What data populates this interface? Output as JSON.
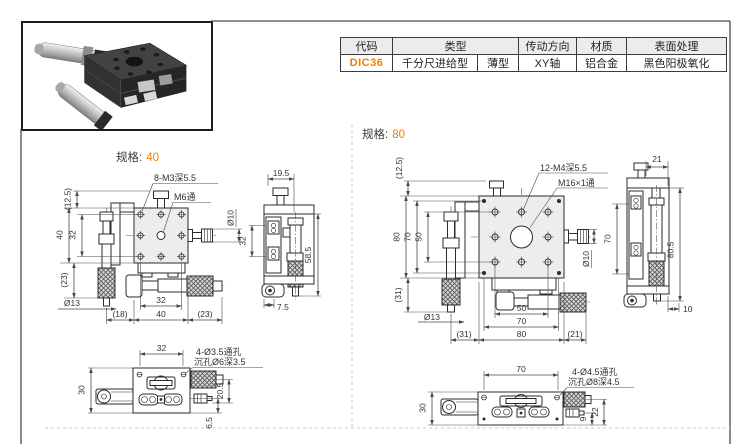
{
  "colors": {
    "accent": "#f07f00",
    "drawing_line": "#2b2b2b",
    "dimension_line": "#4a4a4a",
    "table_header_bg": "#ececec",
    "page_bg": "#ffffff"
  },
  "product_table": {
    "headers": {
      "code": "代码",
      "type": "类型",
      "drive_direction": "传动方向",
      "material": "材质",
      "surface_finish": "表面处理"
    },
    "row": {
      "code": "DIC36",
      "type_main": "千分尺进给型",
      "type_sub": "薄型",
      "drive_direction": "XY轴",
      "material": "铝合金",
      "surface_finish": "黑色阳极氧化"
    }
  },
  "spec40": {
    "spec_label": "规格:",
    "spec_value": "40",
    "top_view": {
      "callout_holes": "8-M3深5.5",
      "callout_center_hole": "M6通",
      "dim_knob_dia": "Ø10",
      "dim_stage_offset": "(12.5)",
      "dim_height": "40",
      "dim_hole_pitch_v": "32",
      "dim_mic_below": "(23)",
      "dim_mic_dia": "Ø13",
      "dim_left_offset": "(18)",
      "dim_hole_pitch_h": "32",
      "dim_width": "40",
      "dim_right_offset": "(23)"
    },
    "side_view": {
      "dim_top": "19.5",
      "dim_left": "32",
      "dim_height": "58.5",
      "dim_bottom": "7.5"
    },
    "bottom_view": {
      "dim_width": "32",
      "callout_holes": "4-Ø3.5通孔",
      "callout_cbore": "沉孔Ø6深3.5",
      "dim_height": "30",
      "dim_right": "20.5",
      "dim_offset": "6.5"
    }
  },
  "spec80": {
    "spec_label": "规格:",
    "spec_value": "80",
    "top_view": {
      "callout_holes": "12-M4深5.5",
      "callout_center_hole": "M16×1通",
      "dim_knob_dia": "Ø10",
      "dim_stage_offset": "(12.5)",
      "dim_height": "80",
      "dim_bracket": "70",
      "dim_hole_pitch_v": "50",
      "dim_mic_below": "(31)",
      "dim_mic_dia": "Ø13",
      "dim_left_offset": "(31)",
      "dim_hole_pitch_h": "50",
      "dim_corner_pitch": "70",
      "dim_width": "80",
      "dim_right_offset": "(21)"
    },
    "side_view": {
      "dim_top": "21",
      "dim_left": "70",
      "dim_height": "80.5",
      "dim_bottom": "10"
    },
    "bottom_view": {
      "dim_width": "70",
      "callout_holes": "4-Ø4.5通孔",
      "callout_cbore": "沉孔Ø8深4.5",
      "dim_height": "30",
      "dim_screw": "9",
      "dim_right": "22"
    }
  }
}
